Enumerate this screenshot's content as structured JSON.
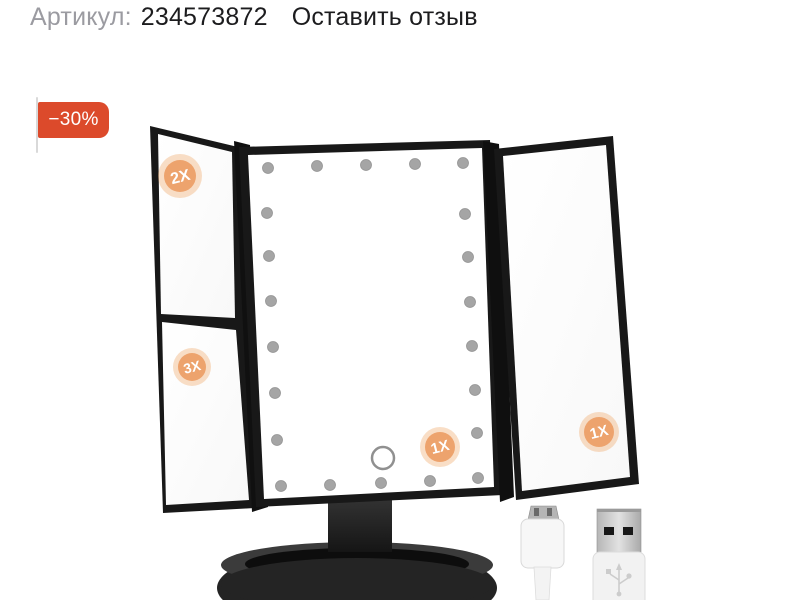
{
  "header": {
    "article_label": "Артикул:",
    "article_number": "234573872",
    "review_link": "Оставить отзыв"
  },
  "discount_badge": {
    "text": "−30%",
    "background_color": "#dc4a2b",
    "text_color": "#ffffff"
  },
  "product": {
    "type_label": "trifold LED makeup mirror with stand",
    "frame_color": "#181818",
    "mirror_color": "#ffffff",
    "led_dot_color": "#a5a5a5",
    "led_count": 22,
    "magnification_badge_inner_color": "#eda36d",
    "magnification_badge_halo_color": "#f0a868",
    "badges": [
      {
        "label": "2X",
        "panel": "left-top"
      },
      {
        "label": "3X",
        "panel": "left-bottom"
      },
      {
        "label": "1X",
        "panel": "center"
      },
      {
        "label": "1X",
        "panel": "right"
      }
    ],
    "accessories": [
      "micro-usb-connector",
      "usb-a-connector"
    ]
  },
  "page": {
    "background_color": "#ffffff"
  }
}
